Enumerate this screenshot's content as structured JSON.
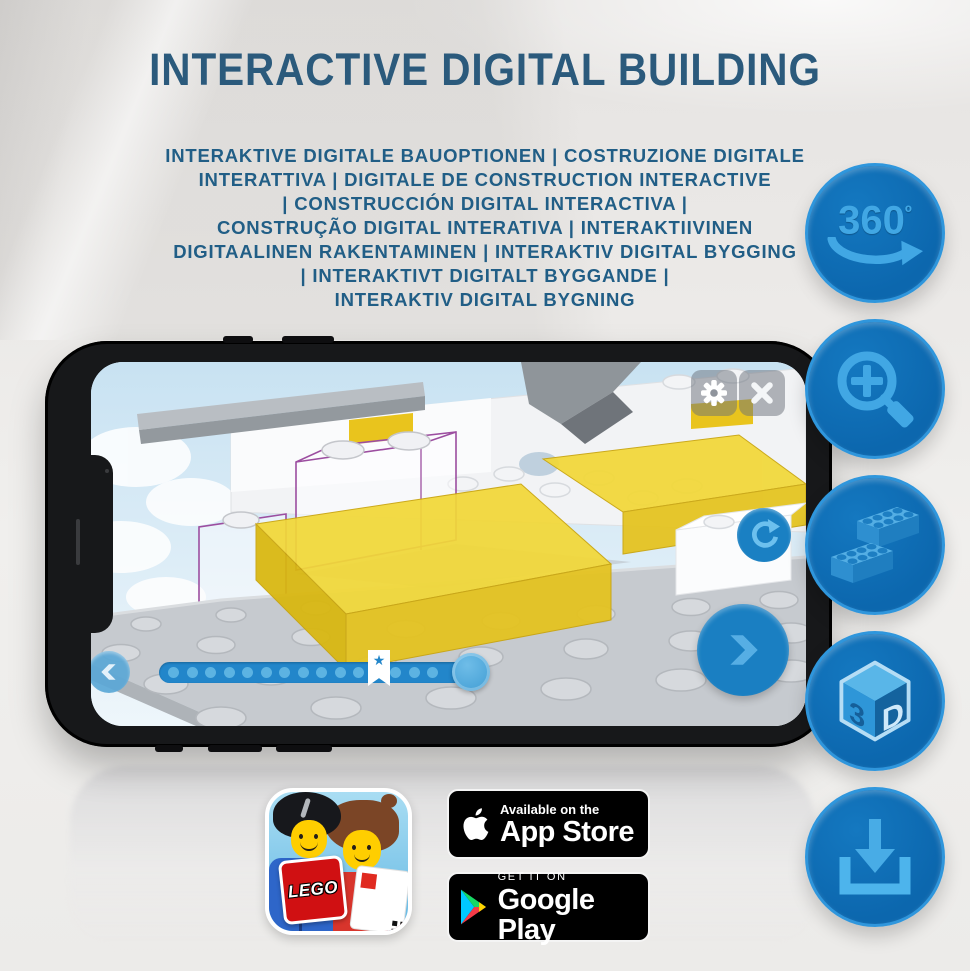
{
  "title": "INTERACTIVE DIGITAL BUILDING",
  "subtitle": {
    "lines": [
      "INTERAKTIVE DIGITALE BAUOPTIONEN | COSTRUZIONE DIGITALE",
      "INTERATTIVA | DIGITALE DE CONSTRUCTION INTERACTIVE",
      "| CONSTRUCCIÓN DIGITAL INTERACTIVA |",
      "CONSTRUÇÃO DIGITAL INTERATIVA | INTERAKTIIVINEN",
      "DIGITAALINEN RAKENTAMINEN | INTERAKTIV DIGITAL BYGGING",
      "| INTERAKTIVT DIGITALT BYGGANDE |",
      "INTERAKTIV DIGITAL BYGNING"
    ]
  },
  "feature_icons": {
    "rotation": {
      "text": "360",
      "sup": "º"
    },
    "cube": {
      "left": "3",
      "right": "D"
    }
  },
  "phone_ui": {
    "bookmark_star_glyph": "★"
  },
  "badges": {
    "app_store": {
      "tagline": "Available on the",
      "store_name": "App Store"
    },
    "google_play": {
      "tagline": "GET IT ON",
      "store_name": "Google Play"
    },
    "lego_app": {
      "logo_text": "LEGO"
    }
  },
  "colors": {
    "title_blue": "#2b5a7c",
    "subtitle_blue": "#215e86",
    "circle_blue": "#0e6eb5",
    "circle_icon_blue": "#41a7e4",
    "app_accent_blue": "#1a7fc2",
    "ghost_outline_purple": "#9c4ea0",
    "brick_yellow": "#f0d432",
    "lego_red": "#d01012"
  }
}
